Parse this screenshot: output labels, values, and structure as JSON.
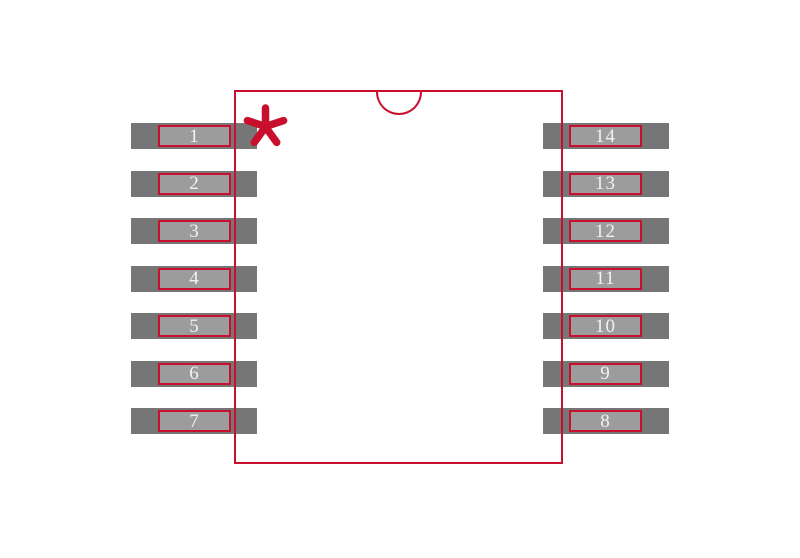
{
  "colors": {
    "background": "#ffffff",
    "outline_red": "#c8102e",
    "pad_gray": "#767676",
    "pad_inner_gray": "#9c9c9c",
    "pin_text": "#f2f2f2"
  },
  "footprint": {
    "pin_count": 14,
    "pins_per_side": 7,
    "pin1_marker": "asterisk",
    "pins": {
      "left": [
        {
          "number": "1"
        },
        {
          "number": "2"
        },
        {
          "number": "3"
        },
        {
          "number": "4"
        },
        {
          "number": "5"
        },
        {
          "number": "6"
        },
        {
          "number": "7"
        }
      ],
      "right": [
        {
          "number": "14"
        },
        {
          "number": "13"
        },
        {
          "number": "12"
        },
        {
          "number": "11"
        },
        {
          "number": "10"
        },
        {
          "number": "9"
        },
        {
          "number": "8"
        }
      ]
    }
  }
}
